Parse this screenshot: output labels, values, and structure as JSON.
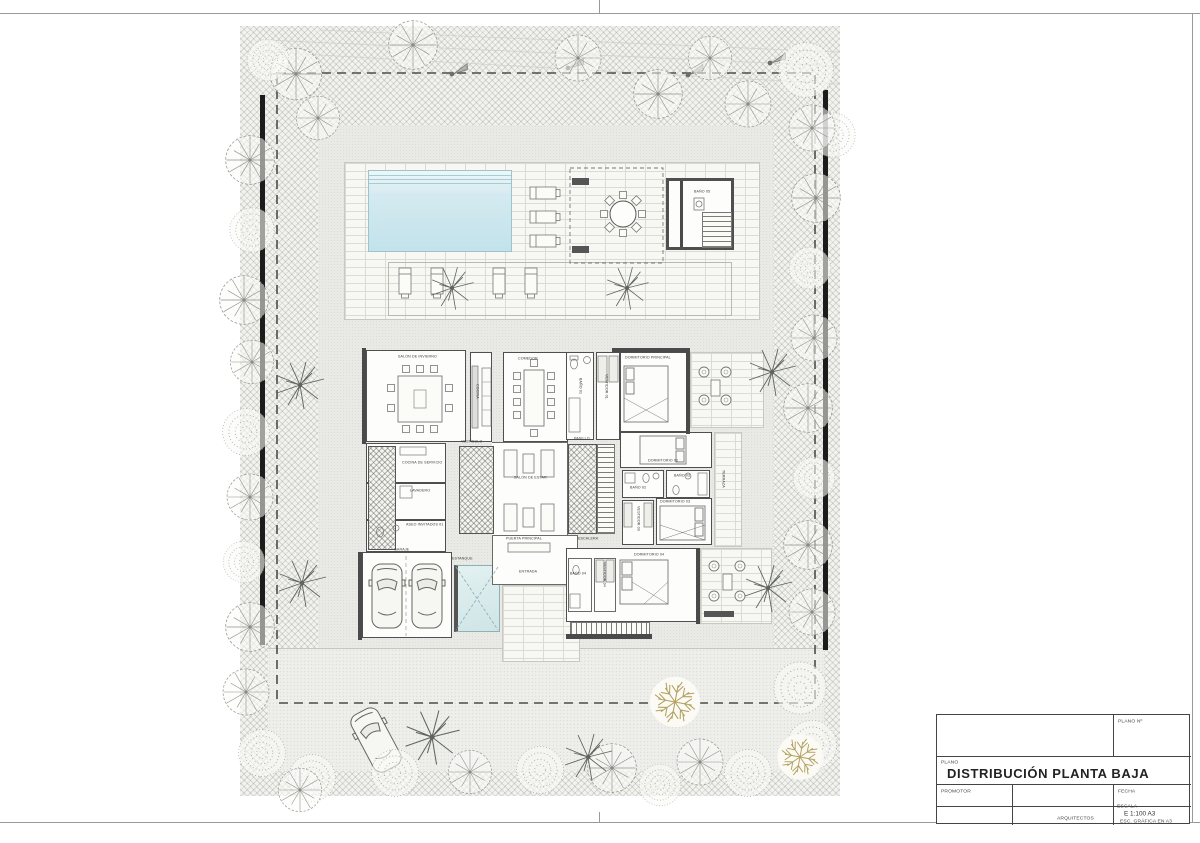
{
  "titleblock": {
    "plano_no_label": "PLANO Nº",
    "plano_label": "PLANO",
    "title": "DISTRIBUCIÓN PLANTA BAJA",
    "promotor_label": "PROMOTOR",
    "fecha_label": "FECHA",
    "arquitectos_label": "ARQUITECTOS",
    "escala_label": "ESCALA",
    "escala_value": "E 1:100   A3",
    "escala_note": "ESC. GRÁFICA EN A3"
  },
  "rooms": {
    "salon_invierno": "SALÓN DE INVIERNO",
    "cocina": "COCINA",
    "comedor": "COMEDOR",
    "vestibulo": "VESTÍBULO",
    "salon_estar": "SALÓN DE ESTAR",
    "pasillo": "PASILLO",
    "escalera": "ESCALERA",
    "cocina_servicio": "COCINA DE SERVICIO",
    "lavadero": "LAVADERO",
    "aseo_invitados": "ASEO INVITADOS 01",
    "garaje": "GARAJE",
    "estanque": "ESTANQUE",
    "entrada": "ENTRADA",
    "puerta_principal": "PUERTA PRINCIPAL",
    "dormitorio_principal": "DORMITORIO PRINCIPAL",
    "bano_01": "BAÑO 01",
    "vestidor_01": "VESTIDOR 01",
    "dormitorio_02": "DORMITORIO 02",
    "bano_02": "BAÑO 02",
    "bano_03": "BAÑO 03",
    "dormitorio_03": "DORMITORIO 03",
    "vestidor_03": "VESTIDOR 03",
    "dormitorio_04": "DORMITORIO 04",
    "bano_04": "BAÑO 04",
    "vestidor_04": "VESTIDOR 04",
    "terraza": "TERRAZA",
    "bano_05": "BAÑO 05"
  },
  "colors": {
    "pool": "#cfe7ee",
    "pond": "#d8eaea",
    "wall": "#4a4a4a",
    "tree": "#96968f",
    "palm": "#5f655c",
    "olive_tree": "#b3a05f",
    "hatch": "#b9b9b2"
  }
}
